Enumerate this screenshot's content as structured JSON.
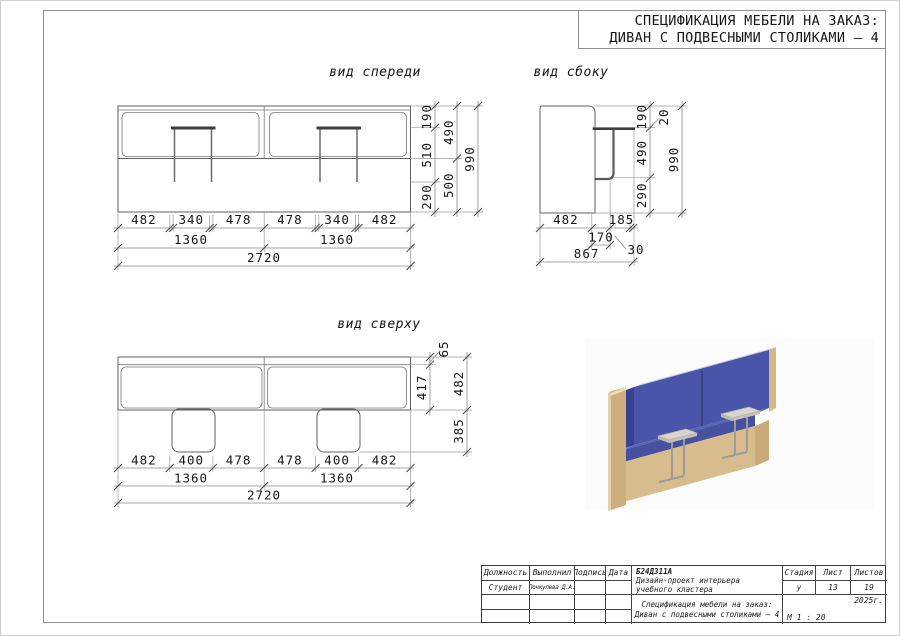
{
  "sheet": {
    "title_line1": "СПЕЦИФИКАЦИЯ МЕБЕЛИ НА ЗАКАЗ:",
    "title_line2": "ДИВАН С ПОДВЕСНЫМИ СТОЛИКАМИ – 4"
  },
  "views": {
    "front": {
      "label": "вид спереди",
      "right": {
        "chain1": [
          "190",
          "510",
          "290"
        ],
        "chain2": [
          "490",
          "500"
        ],
        "total": "990"
      },
      "bottom": {
        "row1": [
          "482",
          "340",
          "478",
          "478",
          "340",
          "482"
        ],
        "row2": [
          "1360",
          "1360"
        ],
        "total": "2720"
      }
    },
    "side": {
      "label": "вид сбоку",
      "right": {
        "chain1": [
          "190",
          "490",
          "290"
        ],
        "callout": "20",
        "total": "990"
      },
      "bottom": {
        "row1": [
          "482",
          "185"
        ],
        "row2": [
          "170",
          "30"
        ],
        "total": "867"
      }
    },
    "top": {
      "label": "вид сверху",
      "right": {
        "strip": "65",
        "depth": "417",
        "chain2": [
          "482",
          "385"
        ]
      },
      "bottom": {
        "row1": [
          "482",
          "400",
          "478",
          "478",
          "400",
          "482"
        ],
        "row2": [
          "1360",
          "1360"
        ],
        "total": "2720"
      }
    }
  },
  "titleblock": {
    "headers": {
      "col1": "Должность",
      "col2": "Выполнил",
      "col3": "Подпись",
      "col4": "Дата",
      "stage": "Стадия",
      "sheet": "Лист",
      "sheets": "Листов"
    },
    "row2": {
      "role": "Студент",
      "name": "Почкулева Д.А."
    },
    "doc_code": "Б24Д311А",
    "project_name": "Дизайн-проект интерьера учебного кластера",
    "sheet_title_line1": "Спецификация мебели на заказ:",
    "sheet_title_line2": "Диван с подвесными столиками – 4",
    "stage_value": "у",
    "sheet_value": "13",
    "sheets_value": "19",
    "year": "2025г.",
    "scale": "М 1 : 20"
  },
  "render_colors": {
    "wood_front": "#d9bc8e",
    "wood_side": "#c9aa7b",
    "wood_end": "#cfae7d",
    "wood_light": "#ecdcbc",
    "blue_back": "#4a54a8",
    "blue_seat_top": "#5663b8",
    "blue_seat_front": "#46519f",
    "blue_wing": "#3a4392",
    "back_rim": "#c9cce0",
    "table_top": "#d8d5cc",
    "table_edge": "#c0bdb4",
    "leg": "#9b9b9b"
  }
}
